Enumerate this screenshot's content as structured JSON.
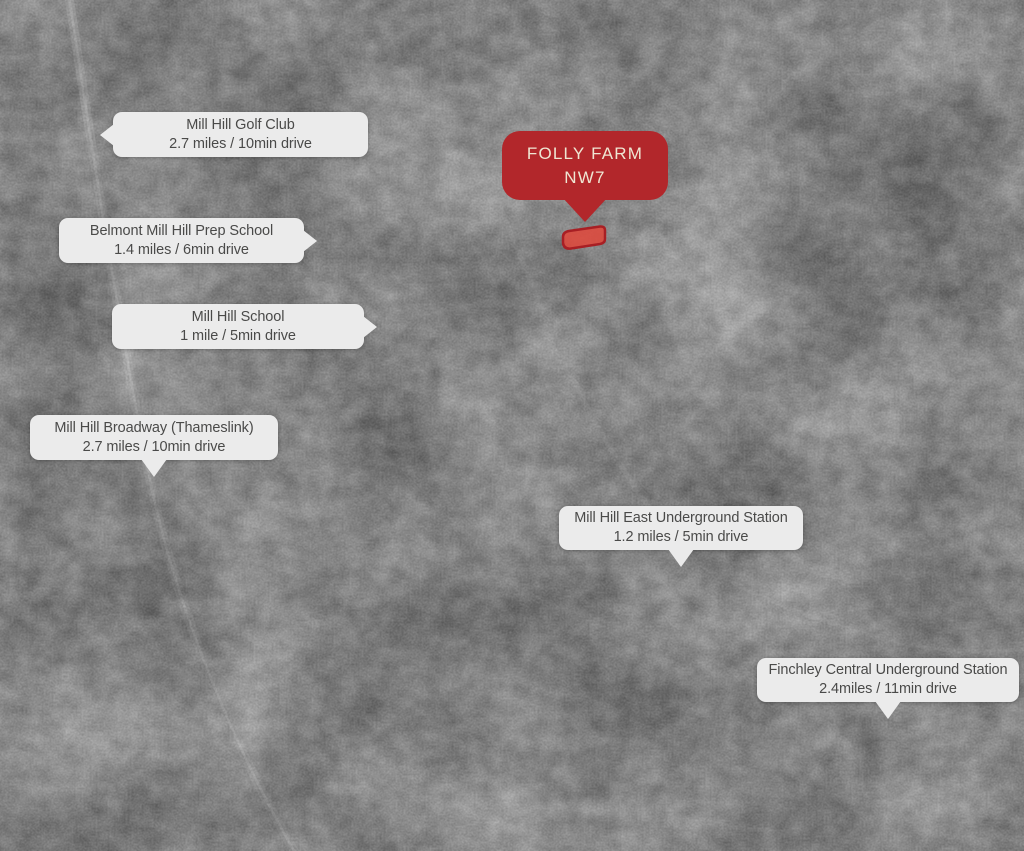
{
  "colors": {
    "accent-red": "#b2272b",
    "marker-text": "#efe6d3",
    "callout-bg": "#ebebeb",
    "callout-text": "#4a4a49",
    "farm-fill": "#dd4a3e",
    "farm-stroke": "#a81f24"
  },
  "property_marker": {
    "name": "FOLLY FARM",
    "postcode": "NW7"
  },
  "callouts": [
    {
      "id": "mill-hill-golf-club",
      "title": "Mill Hill Golf Club",
      "distance": "2.7 miles / 10min drive"
    },
    {
      "id": "belmont-mill-hill-prep",
      "title": "Belmont Mill Hill Prep School",
      "distance": "1.4 miles / 6min drive"
    },
    {
      "id": "mill-hill-school",
      "title": "Mill Hill School",
      "distance": "1 mile / 5min drive"
    },
    {
      "id": "mill-hill-broadway",
      "title": "Mill Hill Broadway (Thameslink)",
      "distance": "2.7 miles / 10min drive"
    },
    {
      "id": "mill-hill-east",
      "title": "Mill Hill East Underground Station",
      "distance": "1.2 miles / 5min drive"
    },
    {
      "id": "finchley-central",
      "title": "Finchley Central Underground Station",
      "distance": "2.4miles / 11min drive"
    }
  ]
}
